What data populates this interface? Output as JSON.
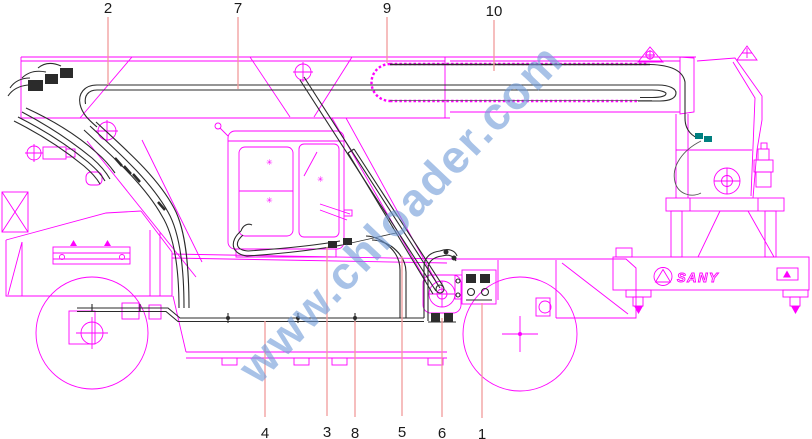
{
  "drawing": {
    "watermark_text": "www.chloader.com",
    "brand_label": "SANY",
    "glass_mark": "✳"
  },
  "colors": {
    "outline": "#FF00FF",
    "hose": "#2B2B2B",
    "hose_light": "#555555",
    "leader": "#F29B9B",
    "label": "#1A1A1A",
    "watermark": "#6F9BD8",
    "fitting": "#007F7F",
    "background": "#FFFFFF"
  },
  "callouts": [
    {
      "label": "2",
      "x": 108,
      "label_y": 13,
      "line_y1": 17,
      "line_y2": 85
    },
    {
      "label": "7",
      "x": 238,
      "label_y": 13,
      "line_y1": 17,
      "line_y2": 89
    },
    {
      "label": "9",
      "x": 387,
      "label_y": 13,
      "line_y1": 17,
      "line_y2": 63
    },
    {
      "label": "10",
      "x": 494,
      "label_y": 16,
      "line_y1": 20,
      "line_y2": 71
    },
    {
      "label": "4",
      "x": 265,
      "label_y": 438,
      "line_y1": 417,
      "line_y2": 321
    },
    {
      "label": "3",
      "x": 327,
      "label_y": 437,
      "line_y1": 416,
      "line_y2": 247
    },
    {
      "label": "8",
      "x": 355,
      "label_y": 438,
      "line_y1": 417,
      "line_y2": 321
    },
    {
      "label": "5",
      "x": 402,
      "label_y": 437,
      "line_y1": 416,
      "line_y2": 256
    },
    {
      "label": "6",
      "x": 442,
      "label_y": 438,
      "line_y1": 417,
      "line_y2": 318
    },
    {
      "label": "1",
      "x": 482,
      "label_y": 439,
      "line_y1": 418,
      "line_y2": 303
    }
  ]
}
